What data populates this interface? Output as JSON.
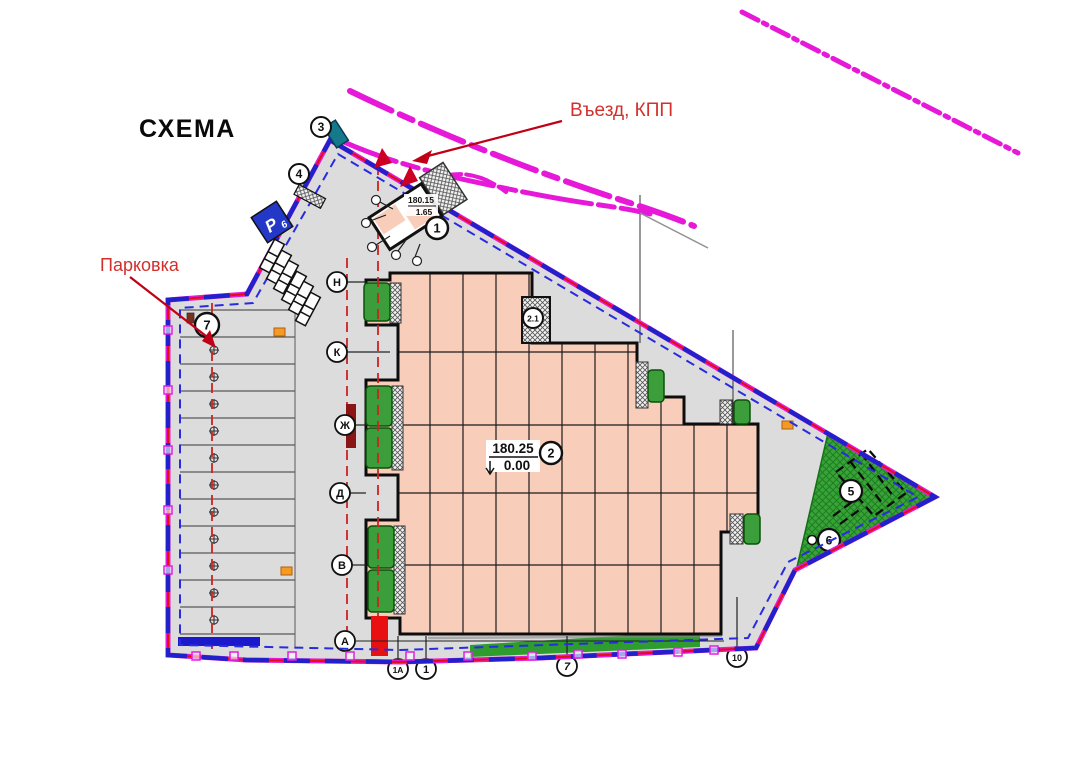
{
  "title": "СХЕМА",
  "annotations": {
    "entrance": "Въезд, КПП",
    "parking": "Парковка"
  },
  "building_label": {
    "elevation": "180.25",
    "level": "0.00"
  },
  "kpp_label": {
    "elevation": "180.15",
    "level": "1.65"
  },
  "parking_sign": {
    "letter": "Р",
    "capacity": "6"
  },
  "markers": {
    "kpp": "1",
    "main_building": "2",
    "annex": "2.1",
    "gate": "3",
    "fence_bar": "4",
    "courts": "5",
    "lawn": "6",
    "parking_lot": "7"
  },
  "axes": {
    "left": [
      "Н",
      "К",
      "Ж",
      "Д",
      "В",
      "А"
    ],
    "bottom": [
      "1А",
      "1",
      "7",
      "10"
    ]
  },
  "colors": {
    "boundary_blue": "#2121CC",
    "boundary_red": "#E01010",
    "road_magenta": "#E619D8",
    "annotation_red": "#C00016",
    "building_fill": "#F8CEBA",
    "site_fill": "#DCDCDC",
    "green_area": "#38A338",
    "parking_sign_blue": "#2438C8",
    "gate_teal": "#15798C",
    "marker_orange": "#F59A23"
  }
}
